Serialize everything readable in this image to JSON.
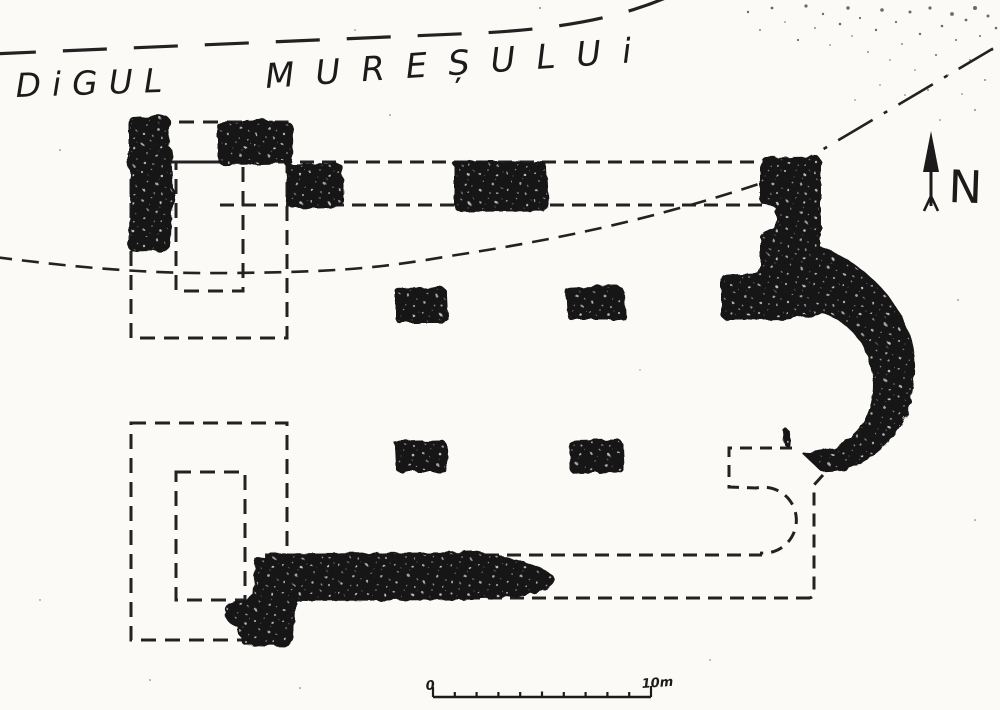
{
  "plan": {
    "title": {
      "left": "DiGUL",
      "right": "MUREȘULUi"
    },
    "compass": {
      "label": "N"
    },
    "scale_bar": {
      "zero_label": "0",
      "end_label": "10m"
    }
  },
  "colors": {
    "ink": "#1c1c1c",
    "paper": "#fbfaf7",
    "masonry_fill": "#191919"
  }
}
